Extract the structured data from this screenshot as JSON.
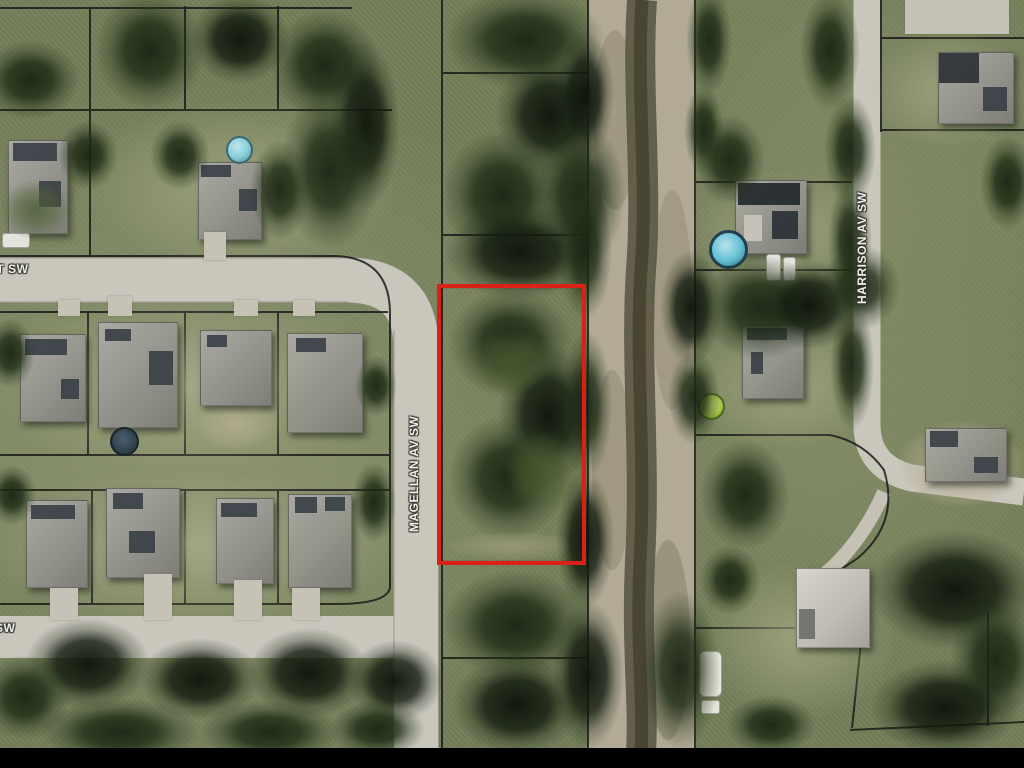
{
  "map": {
    "description": "aerial-parcel-map",
    "street_labels": {
      "magellan": "MAGELLAN AV SW",
      "harrison": "HARRISON AV SW",
      "top_left_partial": "ST SW",
      "bottom_left_partial": "SW"
    },
    "highlight": {
      "name": "subject-parcel-outline",
      "color": "#db2117"
    },
    "colors": {
      "boundary_line": "#161616",
      "road": "#c9c6bc",
      "canal_bank": "#b2aa96",
      "canal_channel": "#53503e",
      "pool_blue": "#62bed4",
      "tank_cyan": "#86ccd8",
      "round_pool_green": "#a6c44a",
      "letterbox": "#000000",
      "label_text": "#f1f0e9"
    }
  }
}
